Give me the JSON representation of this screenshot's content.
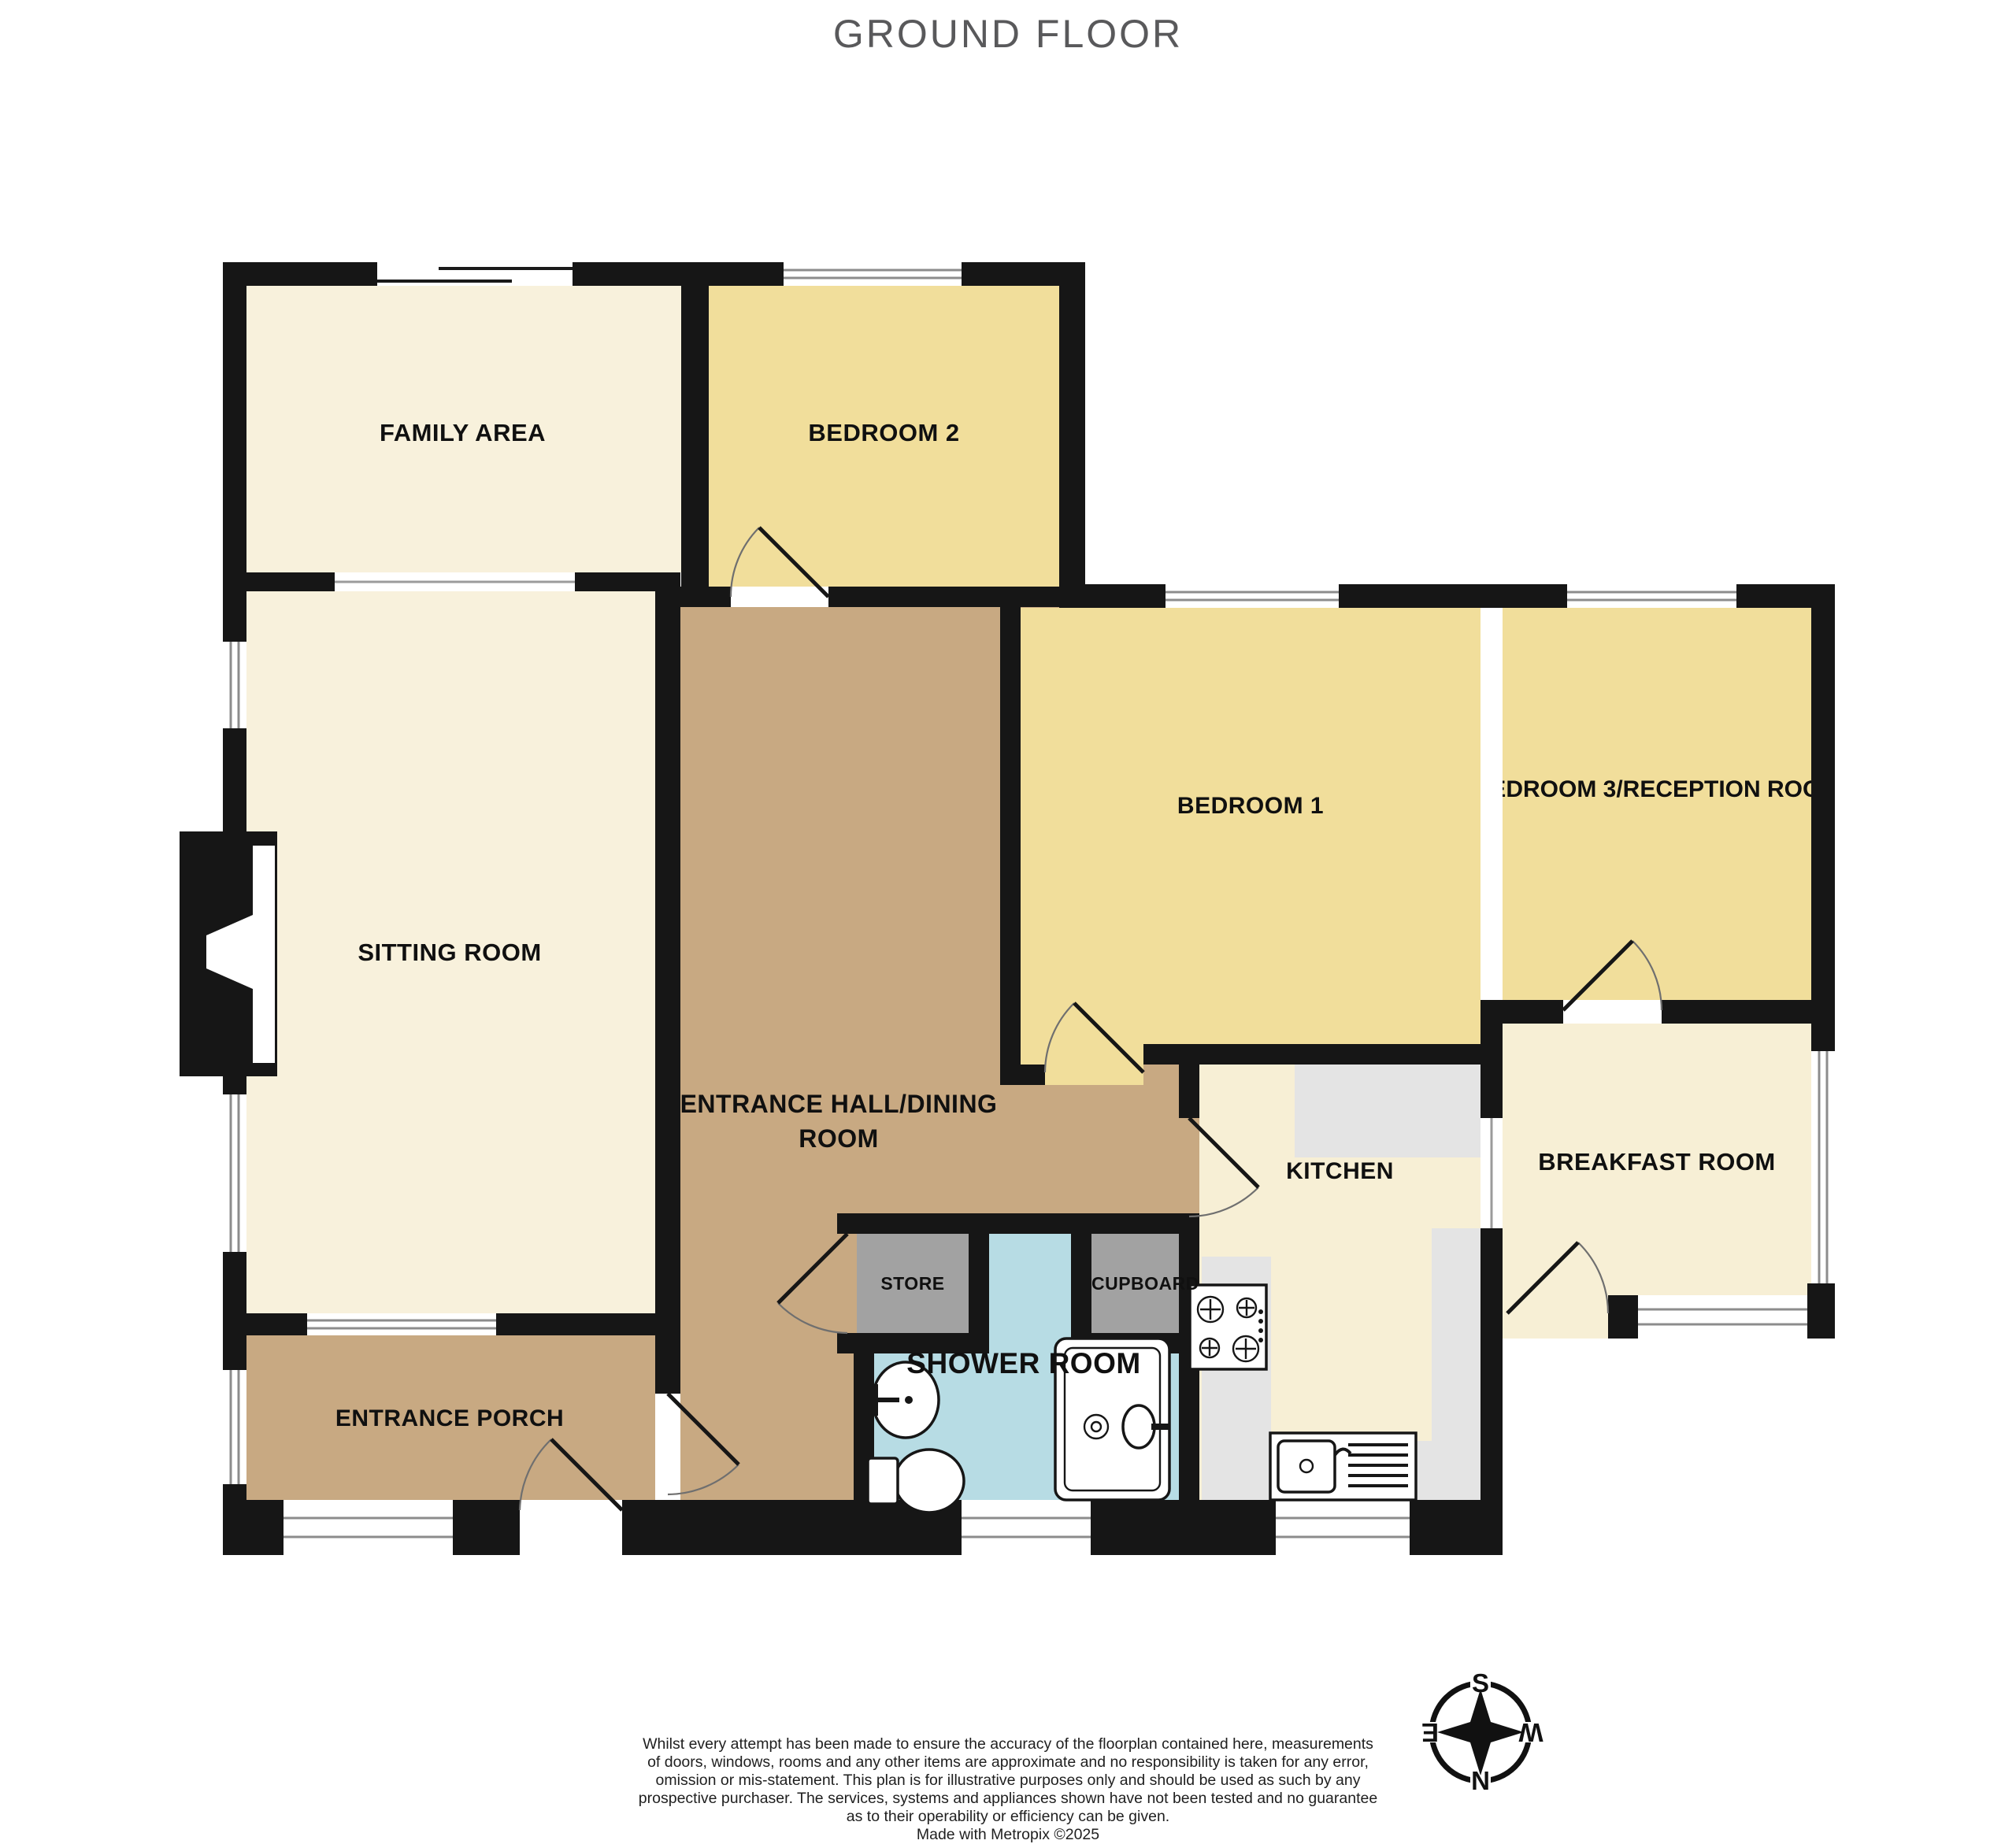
{
  "title": "GROUND FLOOR",
  "floorplan": {
    "rooms": {
      "family_area": {
        "label": "FAMILY AREA"
      },
      "bedroom_2": {
        "label": "BEDROOM 2"
      },
      "sitting_room": {
        "label": "SITTING ROOM"
      },
      "entrance_hall": {
        "label": "ENTRANCE HALL/DINING ROOM",
        "lines": [
          "ENTRANCE HALL/DINING",
          "ROOM"
        ]
      },
      "bedroom_1": {
        "label": "BEDROOM 1"
      },
      "bedroom_3": {
        "label": "BEDROOM 3/RECEPTION ROOM"
      },
      "kitchen": {
        "label": "KITCHEN"
      },
      "breakfast_room": {
        "label": "BREAKFAST ROOM"
      },
      "store": {
        "label": "STORE"
      },
      "cupboard": {
        "label": "CUPBOARD"
      },
      "shower_room": {
        "label": "SHOWER ROOM"
      },
      "entrance_porch": {
        "label": "ENTRANCE PORCH"
      }
    },
    "colors": {
      "wall": "#161616",
      "bedroom_fill": "#F1DE9B",
      "living_fill": "#F8F1DC",
      "kitchen_fill": "#F7EFD5",
      "hall_fill": "#C8A982",
      "shower_fill": "#B7DCE4",
      "store_fill": "#A2A2A2",
      "counter_fill": "#E4E4E4"
    }
  },
  "compass": {
    "north": "N",
    "south": "S",
    "east": "E",
    "west": "W"
  },
  "disclaimer": {
    "lines": [
      "Whilst every attempt has been made to ensure the accuracy of the floorplan contained here, measurements",
      "of doors, windows, rooms and any other items are approximate and no responsibility is taken for any error,",
      "omission or mis-statement. This plan is for illustrative purposes only and should be used as such by any",
      "prospective purchaser. The services, systems and appliances shown have not been tested and no guarantee",
      "as to their operability or efficiency can be given."
    ],
    "credit": "Made with Metropix ©2025"
  }
}
